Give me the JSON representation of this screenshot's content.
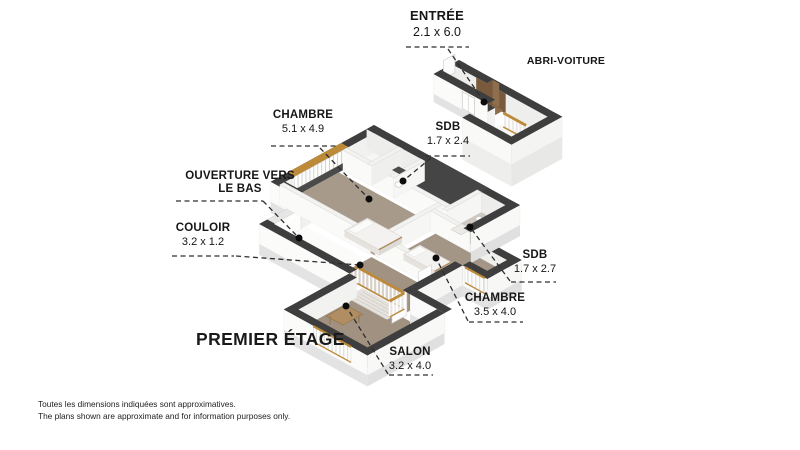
{
  "floor_title": "PREMIER ÉTAGE",
  "footer": {
    "line1": "Toutes les dimensions indiquées sont approximatives.",
    "line2": "The plans shown are approximate and for information purposes only."
  },
  "colors": {
    "wall_top_dark": "#3e3e3e",
    "wall_top_interior": "#f2f2f1",
    "roof_dark": "#454545",
    "wood_trim": "#bd8a3a",
    "floor_bedroom": "#a79a8b",
    "floor_bedroom2": "#a39687",
    "floor_living": "#a09181",
    "floor_corridor": "#a29282",
    "floor_bath": "#cbc6bf",
    "floor_bath2": "#cdc8c1",
    "floor_open": "#fbfbfa",
    "entry_wood_dark": "#6d5138",
    "entry_wood_light": "#b29478",
    "leader": "#2e2e2e",
    "dot": "#0c0c0c"
  },
  "annotations": [
    {
      "id": "entree",
      "name": "ENTRÉE",
      "name2": "",
      "dim": "2.1 x 6.0",
      "cx": 437,
      "top": 8,
      "size": 13,
      "underline": [
        406,
        469,
        47
      ],
      "leader": [
        [
          448,
          49
        ],
        [
          484,
          102
        ]
      ],
      "dot": [
        484,
        102
      ]
    },
    {
      "id": "abri-voiture",
      "name": "ABRI-VOITURE",
      "name2": "",
      "dim": "",
      "cx": 566,
      "top": 55,
      "size": 10.5,
      "underline": null,
      "leader": null,
      "dot": null
    },
    {
      "id": "chambre-1",
      "name": "CHAMBRE",
      "name2": "",
      "dim": "5.1 x 4.9",
      "cx": 303,
      "top": 109,
      "size": 11.5,
      "underline": [
        271,
        336,
        146
      ],
      "leader": [
        [
          320,
          148
        ],
        [
          369,
          199
        ]
      ],
      "dot": [
        369,
        199
      ]
    },
    {
      "id": "sdb-1",
      "name": "SDB",
      "name2": "",
      "dim": "1.7 x 2.4",
      "cx": 448,
      "top": 121,
      "size": 11.5,
      "underline": [
        426,
        470,
        156
      ],
      "leader": [
        [
          431,
          158
        ],
        [
          403,
          181
        ]
      ],
      "dot": [
        403,
        181
      ]
    },
    {
      "id": "ouverture",
      "name": "OUVERTURE VERS",
      "name2": "LE BAS",
      "dim": "",
      "cx": 240,
      "top": 170,
      "size": 11.5,
      "underline": [
        176,
        263,
        201
      ],
      "leader": [
        [
          263,
          201
        ],
        [
          299,
          238
        ]
      ],
      "dot": [
        299,
        238
      ]
    },
    {
      "id": "couloir",
      "name": "COULOIR",
      "name2": "",
      "dim": "3.2 x 1.2",
      "cx": 203,
      "top": 222,
      "size": 11.5,
      "underline": [
        172,
        234,
        256
      ],
      "leader": [
        [
          236,
          256
        ],
        [
          360,
          265
        ]
      ],
      "dot": [
        360,
        265
      ]
    },
    {
      "id": "sdb-2",
      "name": "SDB",
      "name2": "",
      "dim": "1.7 x 2.7",
      "cx": 535,
      "top": 249,
      "size": 11.5,
      "underline": [
        511,
        556,
        282
      ],
      "leader": [
        [
          510,
          281
        ],
        [
          470,
          227
        ]
      ],
      "dot": [
        470,
        227
      ]
    },
    {
      "id": "chambre-2",
      "name": "CHAMBRE",
      "name2": "",
      "dim": "3.5 x 4.0",
      "cx": 495,
      "top": 292,
      "size": 11.5,
      "underline": [
        469,
        523,
        322
      ],
      "leader": [
        [
          468,
          321
        ],
        [
          436,
          258
        ]
      ],
      "dot": [
        436,
        258
      ]
    },
    {
      "id": "salon",
      "name": "SALON",
      "name2": "",
      "dim": "3.2 x 4.0",
      "cx": 410,
      "top": 346,
      "size": 11.5,
      "underline": [
        389,
        433,
        375
      ],
      "leader": [
        [
          388,
          374
        ],
        [
          346,
          306
        ]
      ],
      "dot": [
        346,
        306
      ]
    }
  ],
  "title_pos": {
    "left": 196,
    "top": 329
  }
}
